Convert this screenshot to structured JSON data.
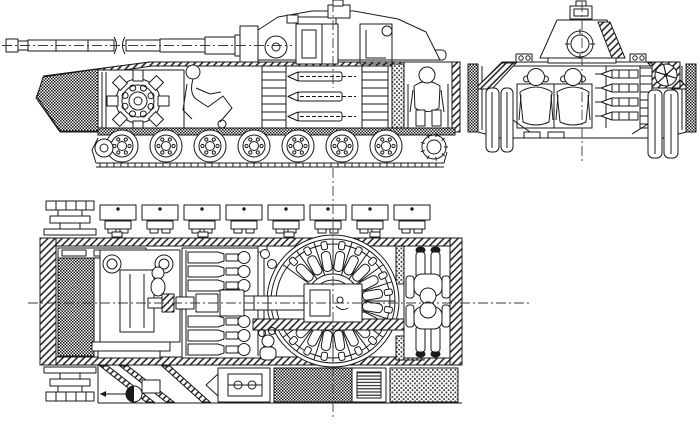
{
  "document": {
    "title": "Tank internal layout cutaway technical drawing, three orthographic views",
    "type": "technical line drawing",
    "background_color": "#ffffff",
    "line_color": "#1a1a1a",
    "hatch_color": "#1a1a1a"
  },
  "views": {
    "side_elevation": {
      "name": "side elevation cutaway",
      "parts": [
        "gun-barrel with break symbol",
        "gun-mantlet and trunnion",
        "low-profile turret with gunner sight",
        "gun breech and recoil cylinder",
        "hatched glacis armor block",
        "front engine with radial accessory drive",
        "reclined driver figure",
        "three rows of stowed shells",
        "stowage columns",
        "rear bulkhead",
        "rear crew compartment with seated crewman and roof hatch",
        "belly armor band",
        "seven road wheels",
        "front idler",
        "rear drive sprocket",
        "track run"
      ]
    },
    "front_section": {
      "name": "front cross-section",
      "parts": [
        "vertical centerline",
        "turret with circular gun mount and top sight",
        "section-hatched turret wall",
        "turret ring",
        "roof periscopes left and right",
        "two seated crew figures with headsets",
        "ammunition rack with four shells",
        "cooling fan",
        "sloped hatched side armor",
        "outer track bands",
        "paired road wheels both sides",
        "belly torsion housings"
      ]
    },
    "plan_view": {
      "name": "top plan cutaway",
      "parts": [
        "horizontal and vertical centerlines",
        "drive sprocket top-left",
        "drive sprocket bottom-left",
        "eight track links upper run",
        "hatched hull perimeter armor",
        "dark cross-hatched engine bay",
        "transmission block with twin drum ends",
        "hull magazine with six stowed rounds",
        "gun barrel, mantlet and cradle on axis",
        "autoloader carousel with radial shells",
        "central breech block",
        "hatched floor section band",
        "gunner figure and hydraulic unit at carousel",
        "two crew figures head-to-head in compartment",
        "dark fuel tank, radiator grille, light fuel tank",
        "suspension struts, wheel-arm pivot and gear unit"
      ]
    }
  }
}
